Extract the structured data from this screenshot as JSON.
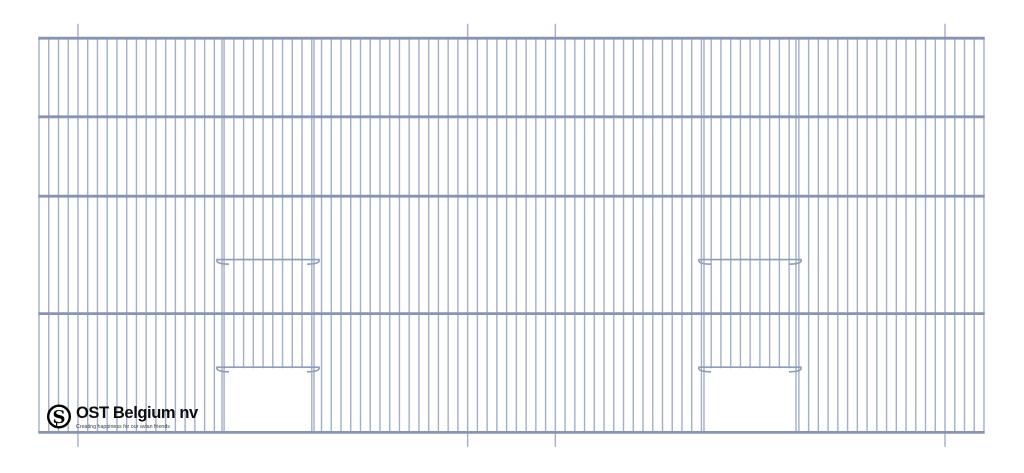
{
  "page": {
    "width": 1024,
    "height": 473,
    "background": "#ffffff"
  },
  "drawing": {
    "description": "wire mesh cage front panel, elevation view",
    "wire_color": "#a2afc6",
    "bar_color": "#8795b2",
    "rail_color": "#8d9cb8",
    "panel": {
      "left": 39,
      "right": 984,
      "top": 38.2,
      "bottom": 432.4
    },
    "bars_y": [
      38.2,
      116.8,
      196.2,
      313.6,
      432.4
    ],
    "bar_thickness": 2.8,
    "wire_spacing": 9.742,
    "wire_count": 98,
    "wire_thickness": 1.4,
    "long_wire_xs": [
      78,
      463,
      551.5,
      943.5
    ],
    "long_wire_overhang": 14.5,
    "door_geometry": {
      "rail_half_span": 51,
      "hook_drop": 4.6,
      "hook_return": 12,
      "upper_rail_y": 259.6,
      "lower_rail_y": 367.2,
      "opening_half_span": 46,
      "opening_top": 368.2,
      "wire_margin": 2.5
    },
    "doors": [
      {
        "name": "left-door",
        "center": 268
      },
      {
        "name": "right-door",
        "center": 750
      }
    ]
  },
  "logo": {
    "brand": "OST Belgium nv",
    "tagline": "Creating happiness for our avian friends",
    "monogram": "S",
    "monogram_small": "J",
    "emblem_color": "#000000",
    "text_color": "#0d0d0d"
  }
}
